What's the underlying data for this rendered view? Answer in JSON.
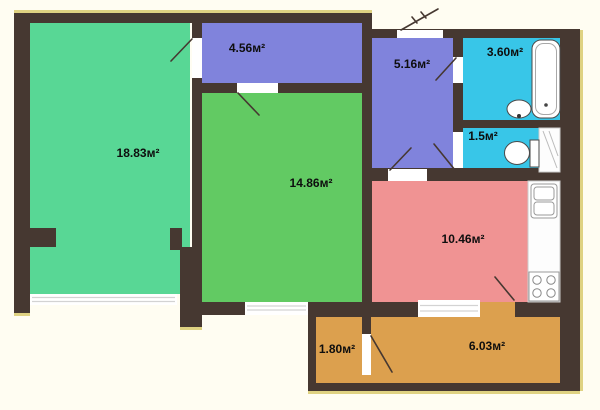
{
  "floor_plan": {
    "background_color": "#fffdf2",
    "wall_color": "#463831",
    "window_color": "#ffffff",
    "accent_edge_color": "#d9ca6f",
    "rooms": {
      "living": {
        "label": "18.83м²",
        "color": "#58d795"
      },
      "top_room": {
        "label": "4.56м²",
        "color": "#8083dc"
      },
      "middle_room": {
        "label": "14.86м²",
        "color": "#62ca63"
      },
      "hallway": {
        "label": "5.16м²",
        "color": "#8083dc"
      },
      "bathroom": {
        "label": "3.60м²",
        "color": "#38c6e8"
      },
      "wc": {
        "label": "1.5м²",
        "color": "#38c6e8"
      },
      "kitchen": {
        "label": "10.46м²",
        "color": "#f09393"
      },
      "balcony_left": {
        "label": "1.80м²",
        "color": "#dca04e"
      },
      "balcony_right": {
        "label": "6.03м²",
        "color": "#dca04e"
      }
    }
  }
}
